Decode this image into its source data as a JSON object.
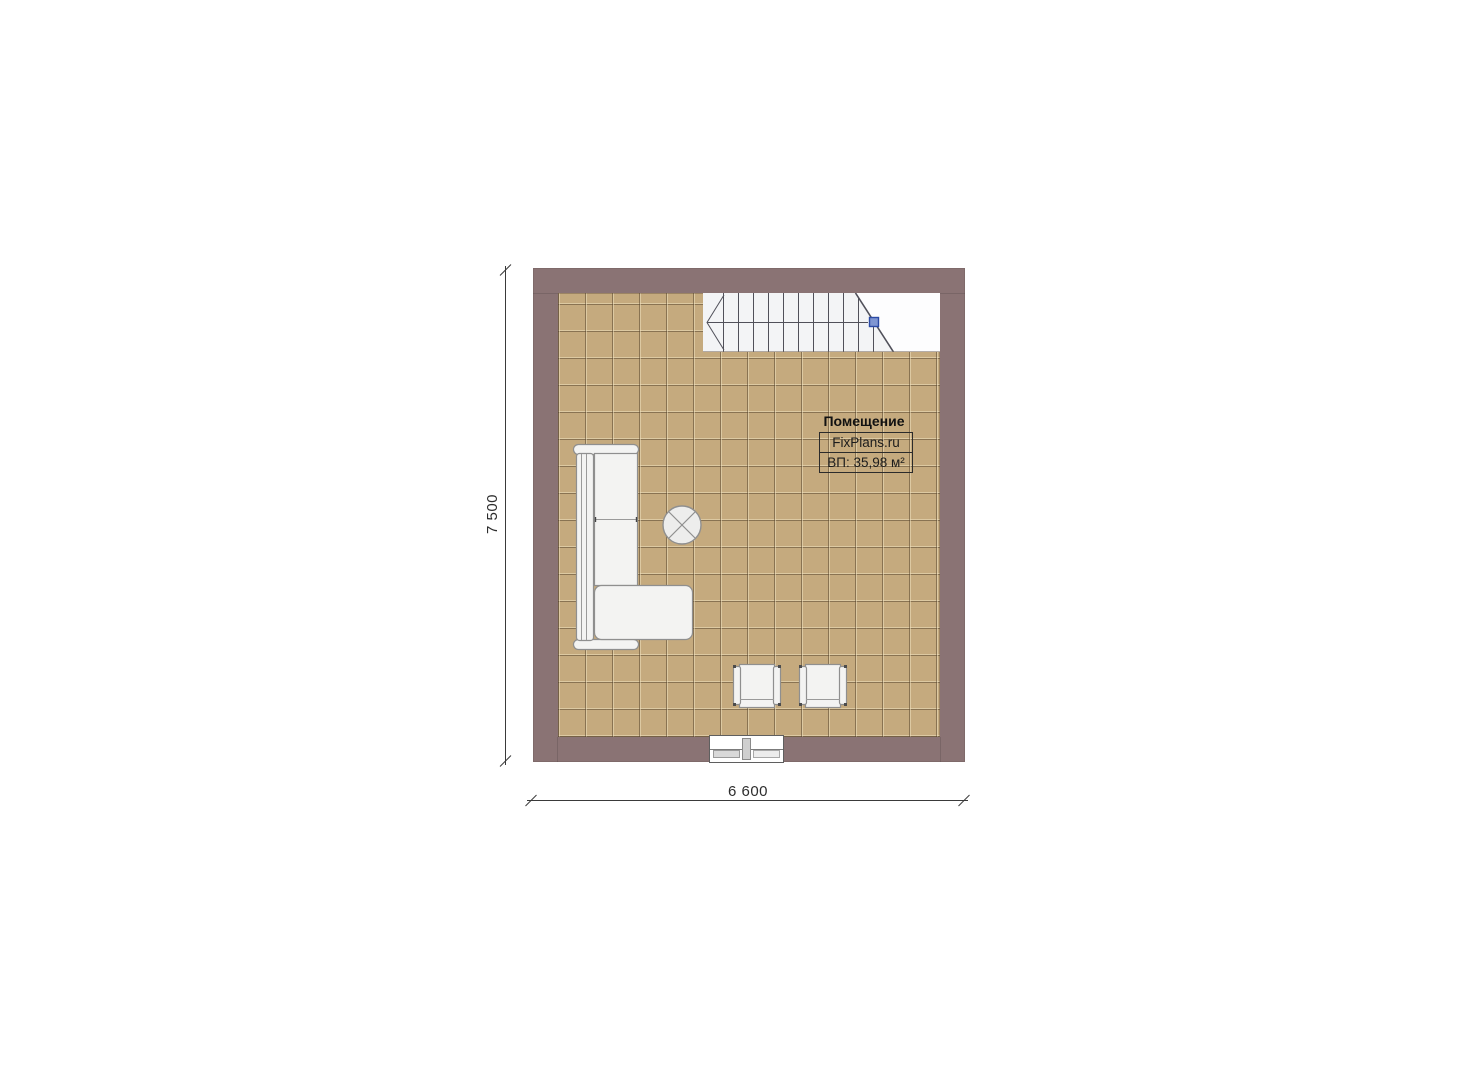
{
  "plan": {
    "room_label": {
      "title": "Помещение",
      "brand": "FixPlans.ru",
      "area": "ВП: 35,98 м²"
    },
    "dimensions": {
      "bottom_width": "6 600",
      "left_height": "7 500"
    }
  },
  "colors": {
    "wall": "#8a7374",
    "floor_tile": "#c5aa7e",
    "stair_fill": "#f3f4f6",
    "stair_line": "#50505a",
    "furniture_fill": "#f3f3f2",
    "furniture_stroke": "#8f8f8f",
    "marker_blue": "#4a66b8",
    "dimension_line": "#3a3a3a",
    "label_text": "#111111"
  }
}
